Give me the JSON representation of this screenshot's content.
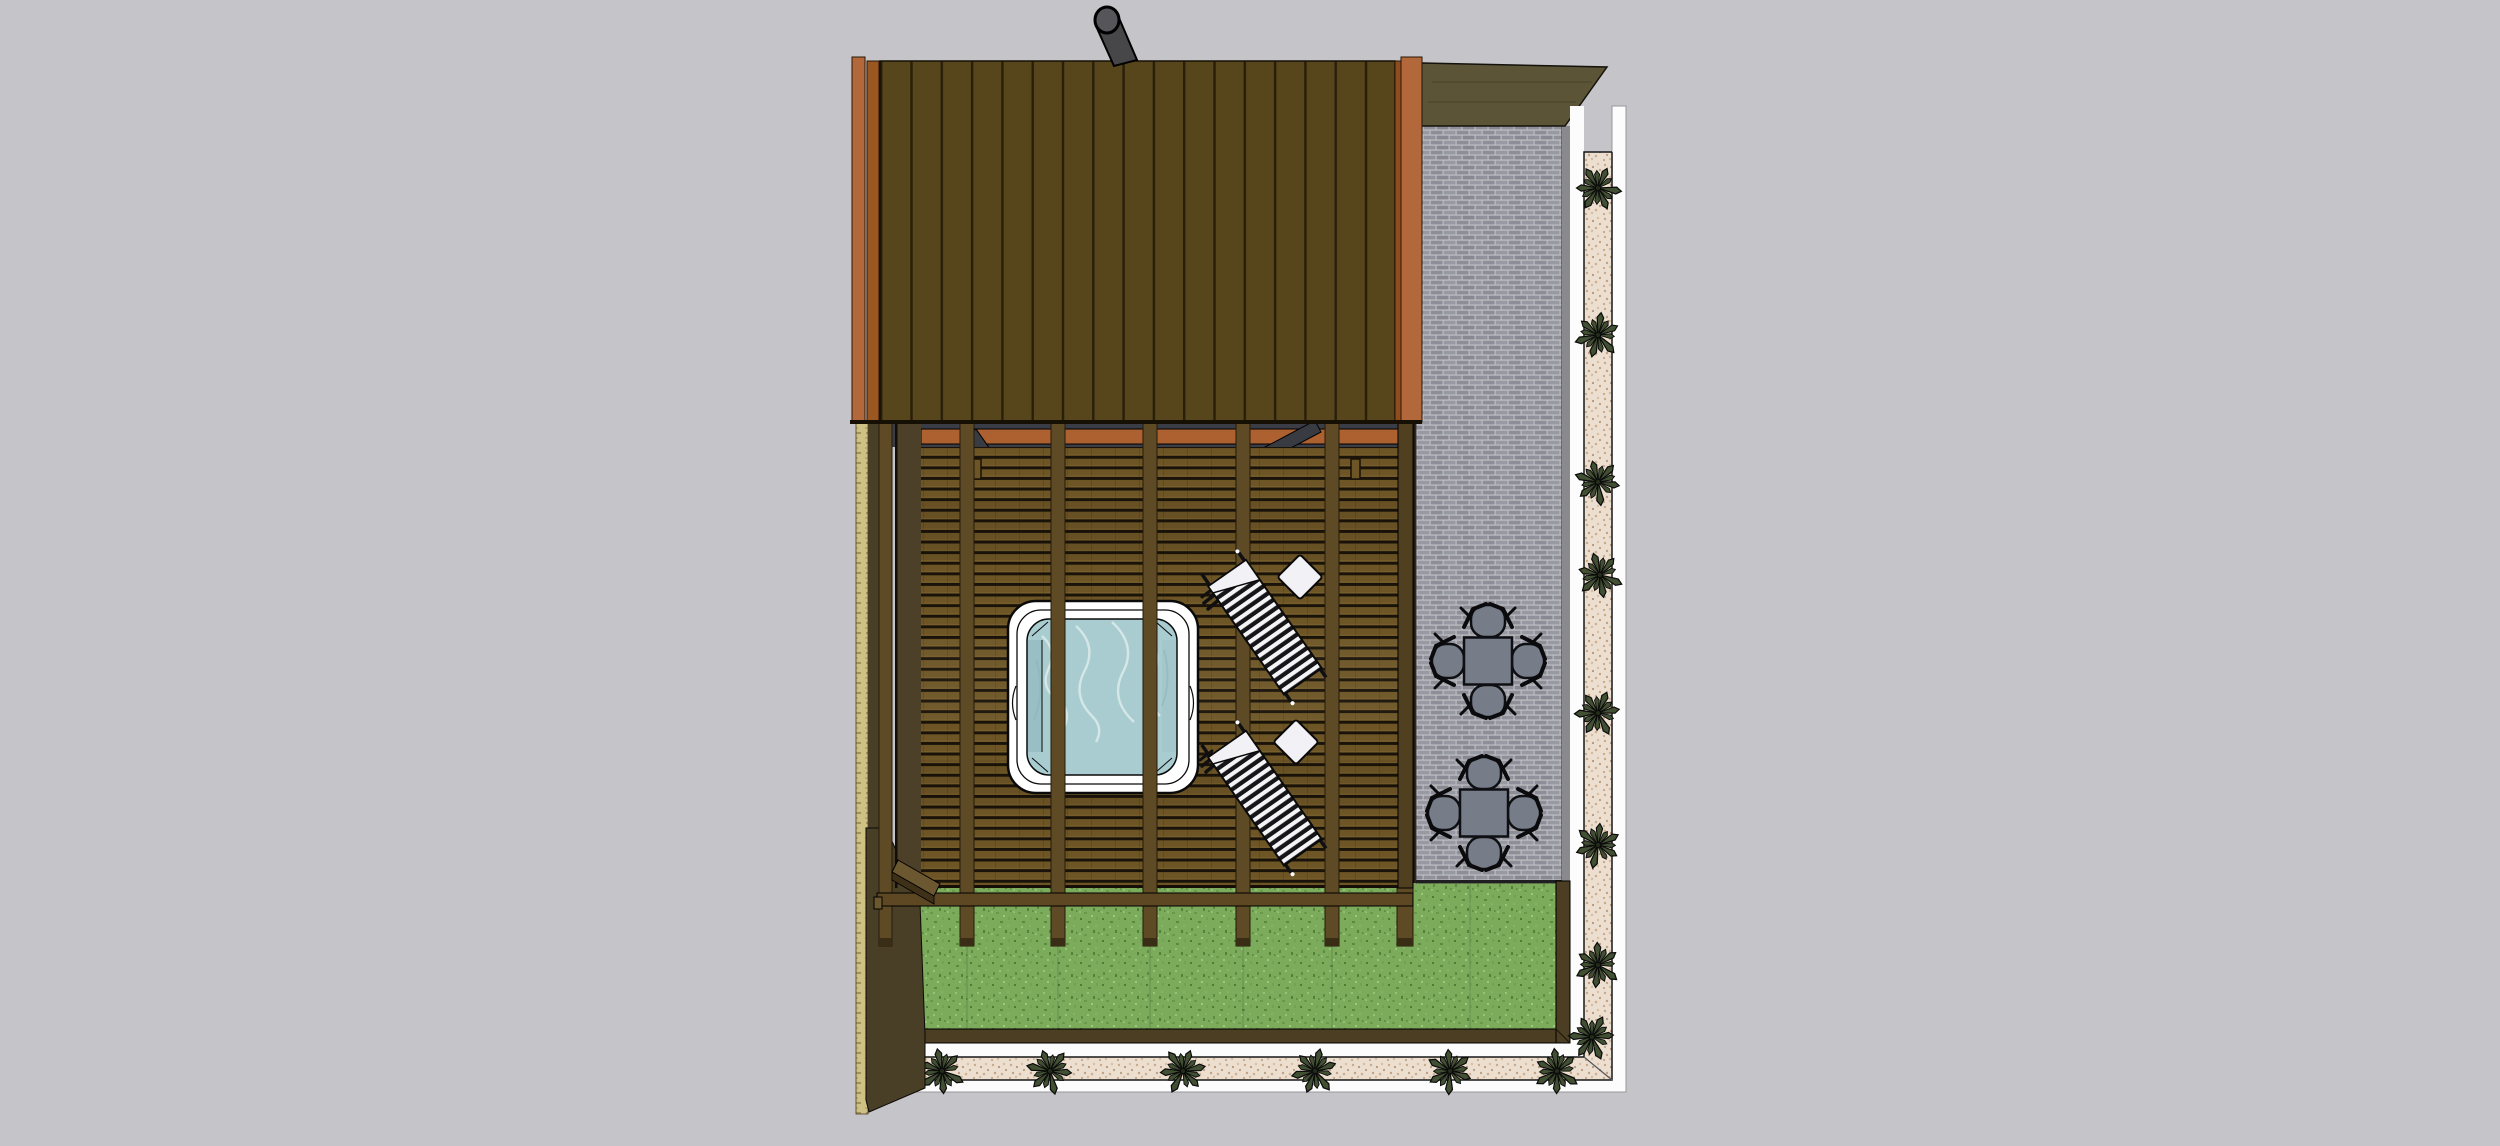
{
  "app": {
    "name": "3d-model-viewport",
    "view": "top-down plan render of a garden with sauna cabin, pergola deck, hot tub, loungers, brick patio and planted gravel border"
  },
  "colors": {
    "background": "#c5c5c9",
    "roof": "#57451b",
    "roof_line": "#281f09",
    "trim_bright": "#b2683a",
    "trim_mid": "#9a571f",
    "trim_dark": "#8f4d1e",
    "wall_top_olive": "#5b5437",
    "chimney": "#47474a",
    "chimney_cap": "#55555a",
    "brick": "#8e8e98",
    "brick_mortar": "#c3c3c7",
    "curb_gray": "#8a8a8e",
    "deck_slat": "#6d5525",
    "deck_gap": "#1a1309",
    "left_band": "#4c4128",
    "shadow_slate": "#3a3d45",
    "beam_orange": "#ad6130",
    "brace_gray": "#383b42",
    "post_brown": "#5e4b25",
    "post_tip": "#3a2d15",
    "bench_brown": "#5e4824",
    "tub_shell": "#ffffff",
    "tub_seat": "#97bcc2",
    "water": "#a9ccd1",
    "water_swirl": "#d9eae9",
    "lounger_black": "#16161a",
    "lounger_white": "#f4f4f7",
    "pillow_white": "#f2f2f6",
    "furniture_gray": "#767d89",
    "grass": "#7cab5b",
    "timber_border": "#4c3e22",
    "path_white": "#fcfcfd",
    "gravel": "#ecdfcf",
    "plant_green": "#415032",
    "plant_center": "#222c18",
    "wall_dark": "#493e26",
    "wall_tan": "#cfc083"
  },
  "scene": {
    "cabin": {
      "label": "sauna cabin roof",
      "plank_count": 17,
      "chimney": "steel flue pipe"
    },
    "pergola": {
      "label": "slatted pergola deck",
      "beam_count": 5,
      "braces": 2,
      "bench": "rear bench rail"
    },
    "hot_tub": {
      "label": "square hot tub with water"
    },
    "loungers": {
      "count": 2,
      "style": "striped sun loungers",
      "pillow_count": 2
    },
    "patio": {
      "label": "grey brick patio",
      "dining_set_count": 2,
      "chairs_per_set": 4
    },
    "lawn": {
      "label": "grass lawn"
    },
    "border": {
      "label": "white edged gravel planting strip",
      "plants_right": 7,
      "plants_bottom": 6,
      "plants_corner": 1
    }
  }
}
